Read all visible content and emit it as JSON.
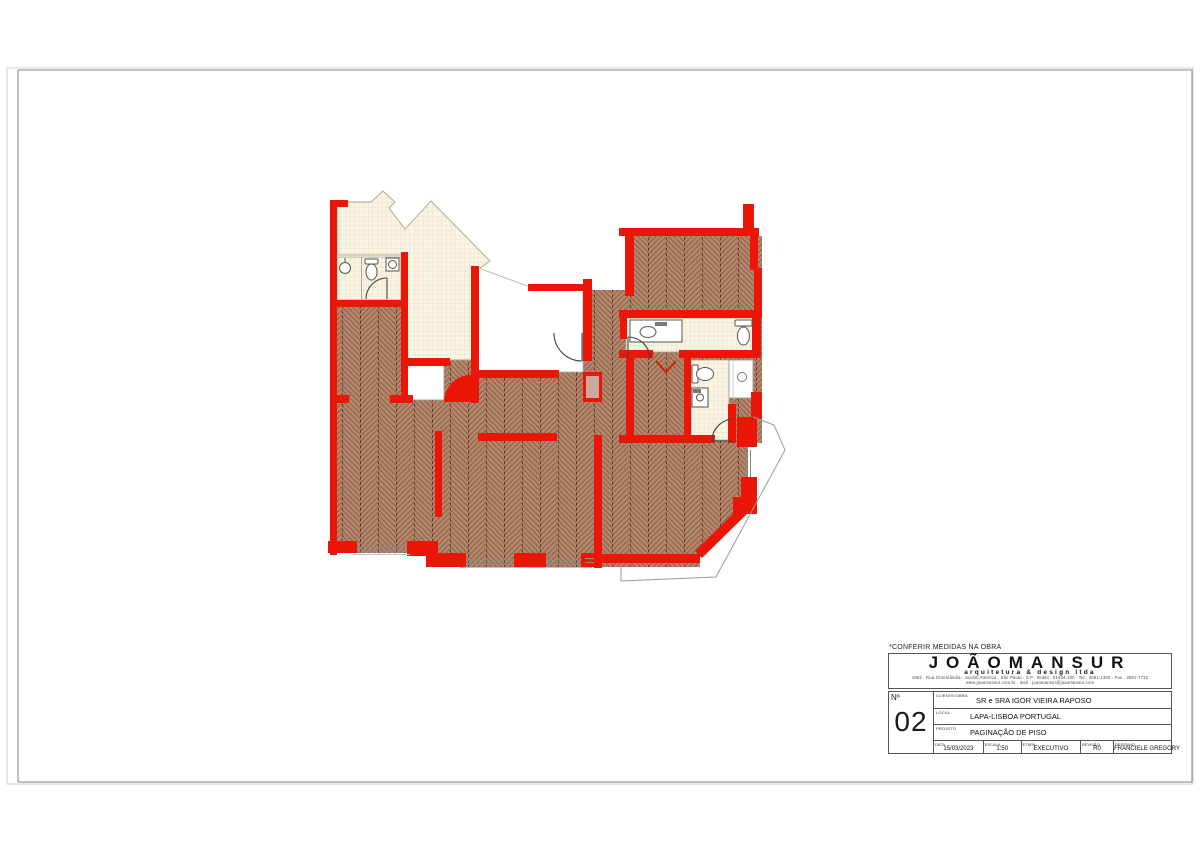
{
  "note": "*CONFERIR MEDIDAS NA OBRA",
  "logo": {
    "name": "JOÃOMANSUR",
    "tagline": "arquitetura & design ltda",
    "address_line1": "1952 . Rua Groenlândia . Jardim América . São Paulo . S.P . Brasil . 01434-100 . Tel . 3081-1300 . Fax . 3081-7732",
    "address_line2": "www.joaomansur.com.br . mail . joaomansur@joaomansur.com"
  },
  "title_block": {
    "number_label": "Nº",
    "number": "02",
    "fields": [
      {
        "label": "CLIENTE/OBRA",
        "value": "SR e SRA IGOR VIEIRA RAPOSO"
      },
      {
        "label": "LOCAL",
        "value": "LAPA-LISBOA PORTUGAL"
      },
      {
        "label": "PROJETO",
        "value": "PAGINAÇÃO DE PISO"
      }
    ],
    "meta": [
      {
        "label": "DATA",
        "value": "15/03/2023"
      },
      {
        "label": "ESCALA",
        "value": "1:50"
      },
      {
        "label": "ETAPA",
        "value": "EXECUTIVO"
      },
      {
        "label": "REVISÃO",
        "value": "R0"
      },
      {
        "label": "DESENHO",
        "value": "FRANCIELE GREGORY"
      }
    ]
  },
  "colors": {
    "wall_red": "#ea1708",
    "wood_floor": "#b3876c",
    "wood_hatch": "#6e3a28",
    "tile_floor": "#f9f4e4",
    "tile_grid": "#ded2ac",
    "frame_gray": "#9a9a9a"
  }
}
